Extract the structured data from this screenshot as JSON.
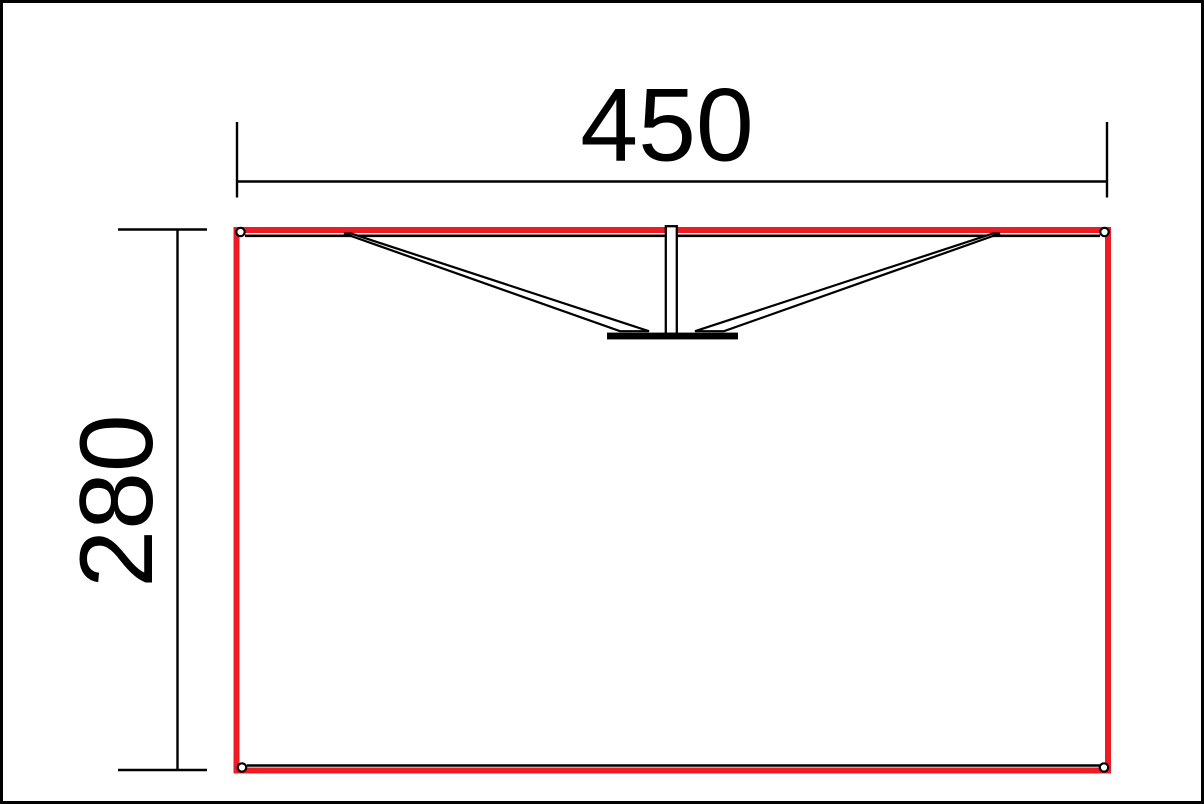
{
  "drawing": {
    "width_dimension": {
      "label": "450"
    },
    "height_dimension": {
      "label": "280"
    },
    "colors": {
      "outline_red": "#ed1c24",
      "line_black": "#000000"
    }
  }
}
